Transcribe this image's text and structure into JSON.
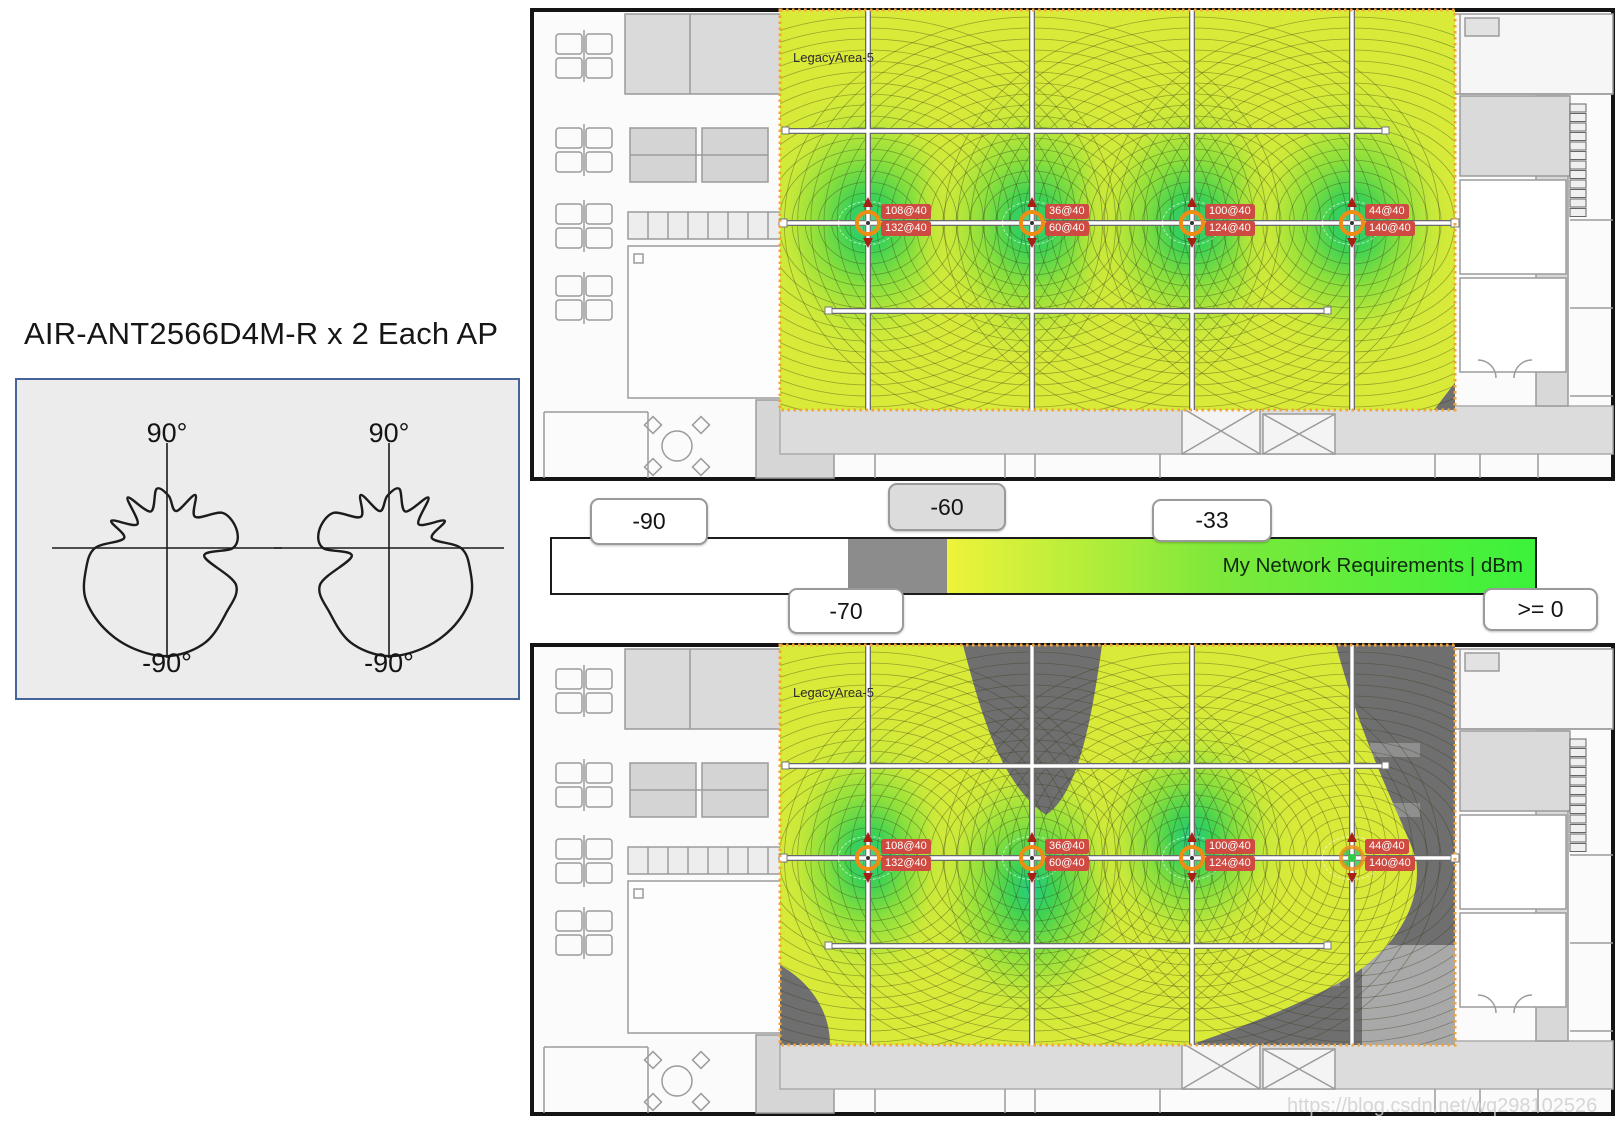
{
  "title": "AIR-ANT2566D4M-R x 2 Each AP",
  "antenna_panel": {
    "patterns": [
      {
        "top_label": "90°",
        "bottom_label": "-90°"
      },
      {
        "top_label": "90°",
        "bottom_label": "-90°"
      }
    ]
  },
  "legend": {
    "title": "My Network Requirements | dBm",
    "badges": {
      "minus90": "-90",
      "minus70": "-70",
      "minus60": "-60",
      "minus33": "-33",
      "gte_zero": ">= 0"
    },
    "colors": {
      "below_range": "#ffffff",
      "gray_zone": "#8c8c8c",
      "gradient_start": "#eef33a",
      "gradient_end": "#3bf23b"
    }
  },
  "heatmap_top": {
    "area_label": "LegacyArea-5",
    "aps": [
      {
        "labels": [
          "108@40",
          "132@40"
        ]
      },
      {
        "labels": [
          "36@40",
          "60@40"
        ]
      },
      {
        "labels": [
          "100@40",
          "124@40"
        ]
      },
      {
        "labels": [
          "44@40",
          "140@40"
        ]
      }
    ]
  },
  "heatmap_bottom": {
    "area_label": "LegacyArea-5",
    "aps": [
      {
        "labels": [
          "108@40",
          "132@40"
        ]
      },
      {
        "labels": [
          "36@40",
          "60@40"
        ]
      },
      {
        "labels": [
          "100@40",
          "124@40"
        ]
      },
      {
        "labels": [
          "44@40",
          "140@40"
        ]
      }
    ]
  },
  "colors": {
    "ap_badge": "#cf4a40",
    "ap_ring_orange": "#ef8d13",
    "coverage_yellow": "#d9ea39",
    "coverage_green_core": "#24cd82",
    "no_coverage_gray": "#6f6f6f",
    "survey_border_orange": "#f2a33c"
  },
  "watermark": "https://blog.csdn.net/wq298102526"
}
